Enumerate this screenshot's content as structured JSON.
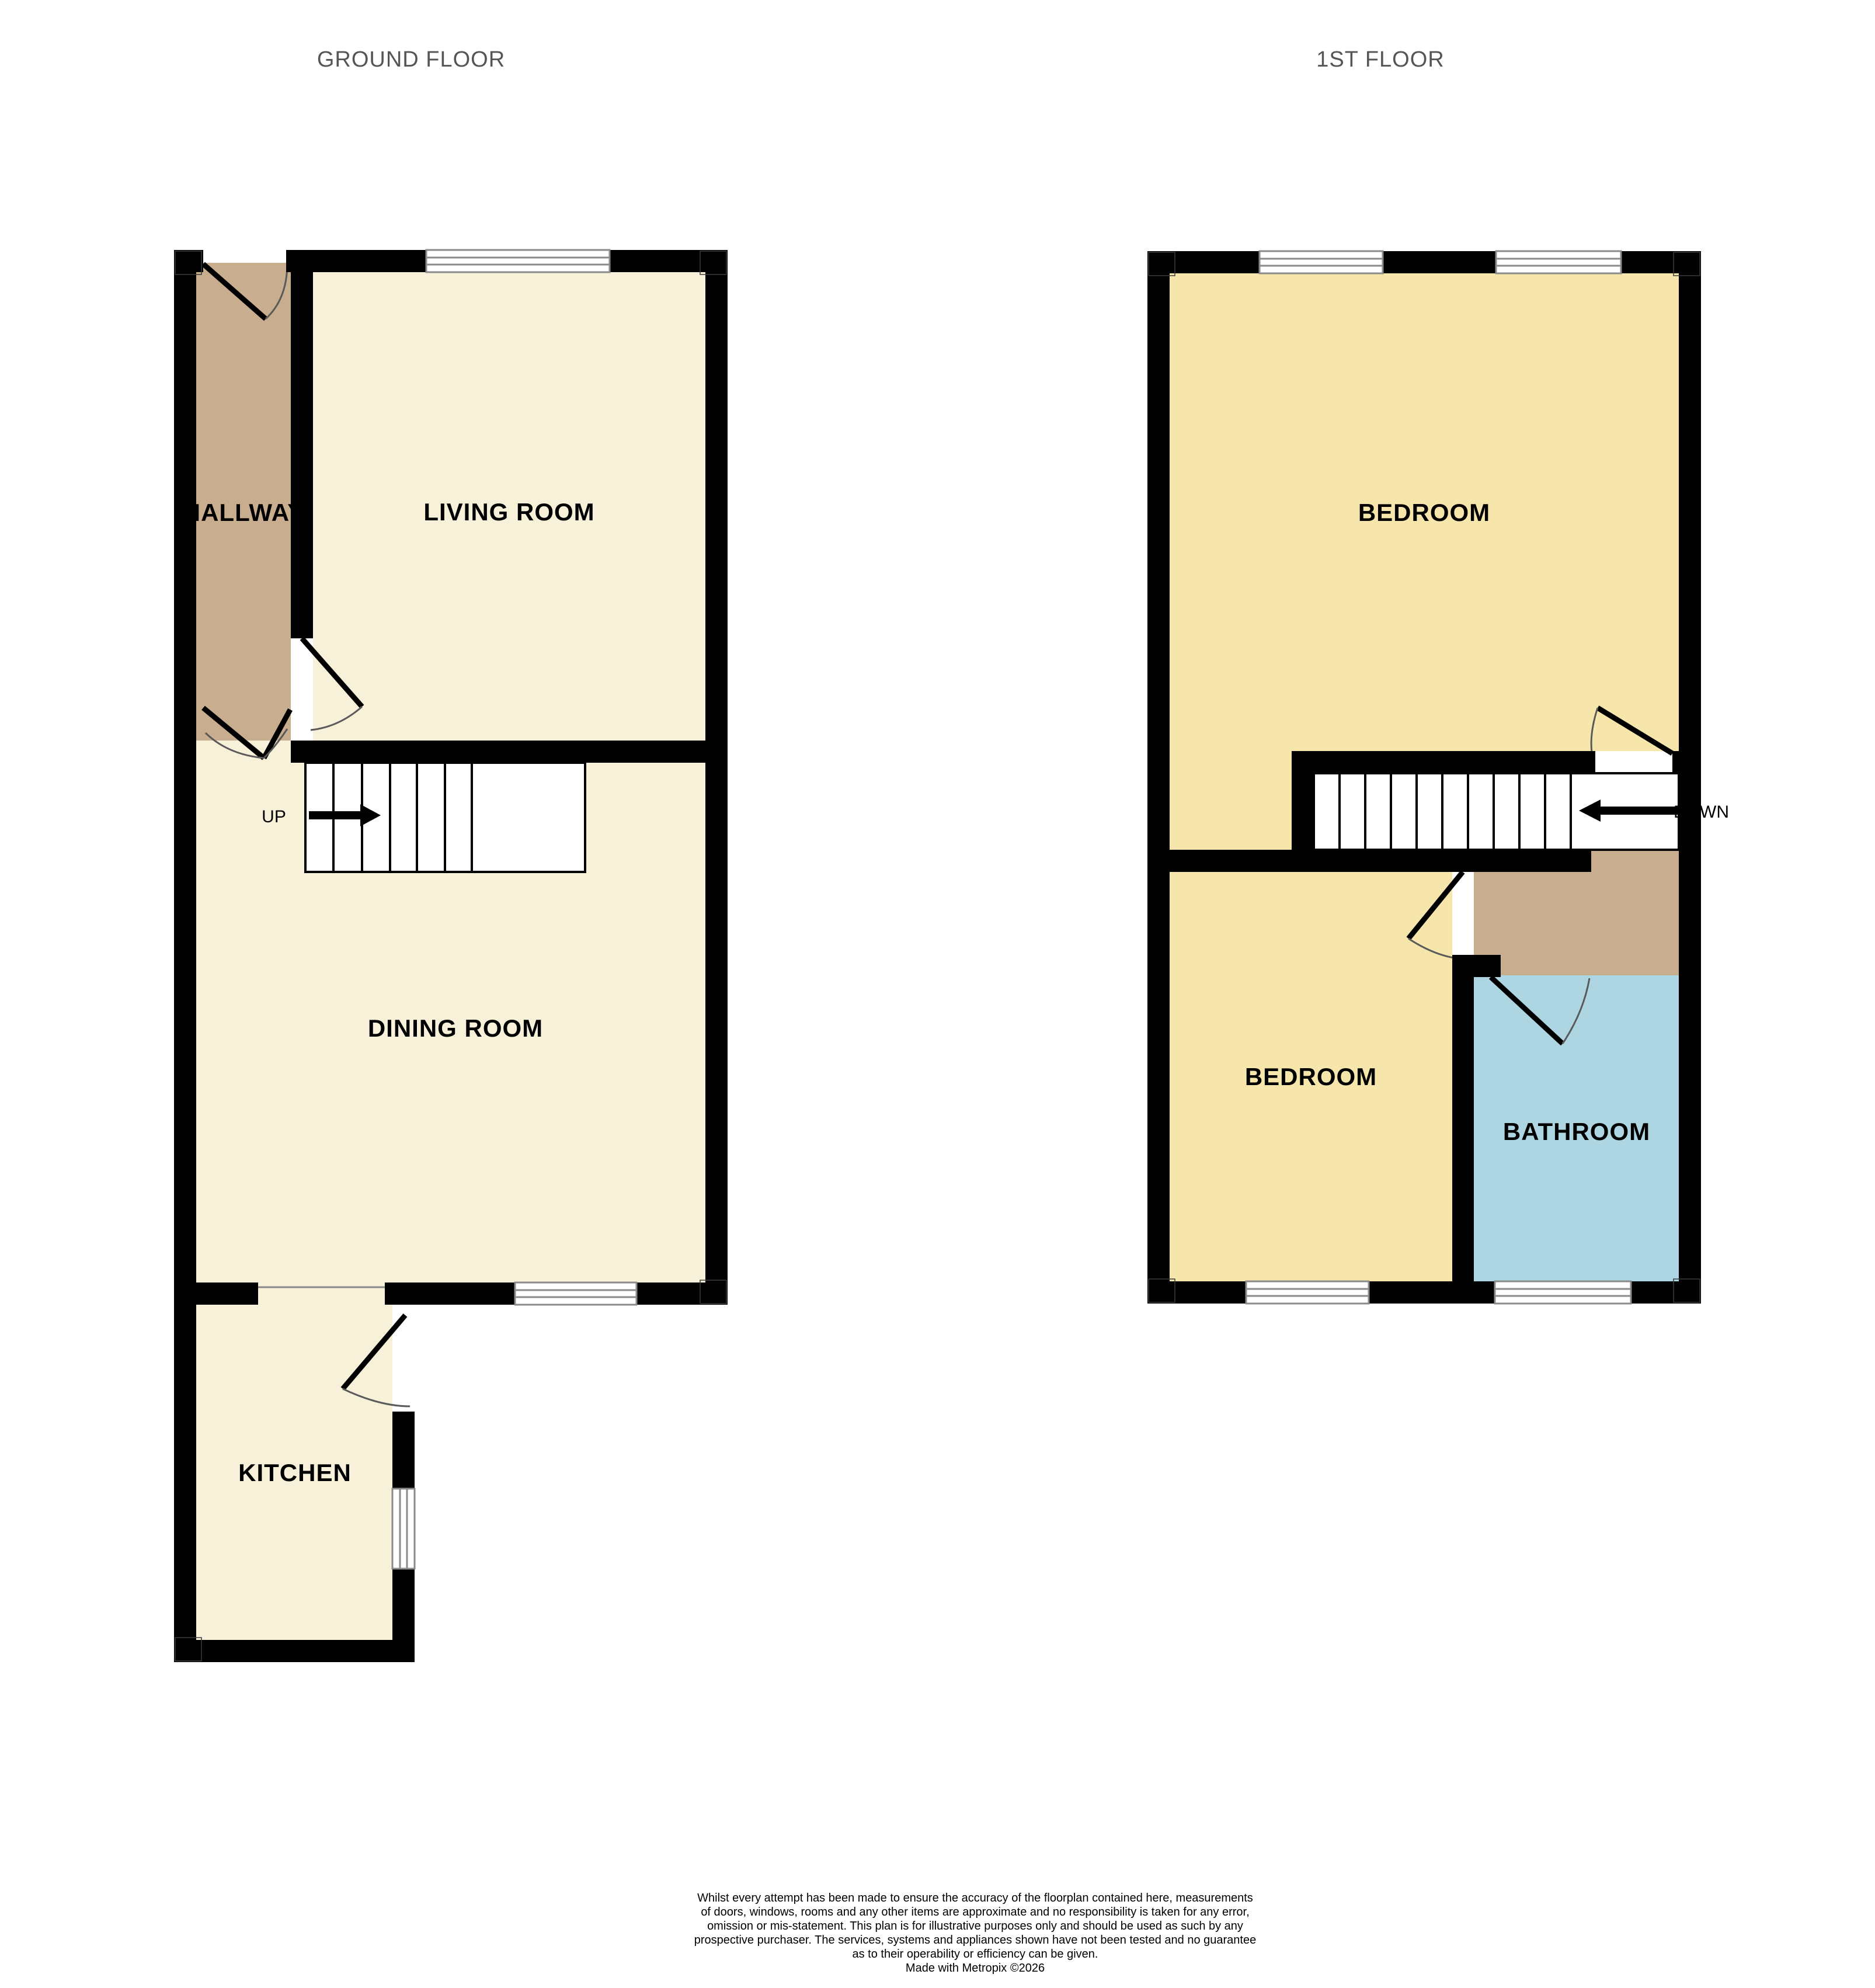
{
  "ground_floor": {
    "label": "GROUND FLOOR",
    "hallway": "HALLWAY",
    "living_room": "LIVING ROOM",
    "dining_room": "DINING ROOM",
    "kitchen": "KITCHEN",
    "stair_direction": "UP"
  },
  "first_floor": {
    "label": "1ST FLOOR",
    "bedroom1": "BEDROOM",
    "bedroom2": "BEDROOM",
    "bathroom": "BATHROOM",
    "stair_direction": "DOWN"
  },
  "colors": {
    "wall": "#000000",
    "room_cream": "#F7F1DA",
    "hallway_tan": "#C8AE8E",
    "landing_tan": "#C8AE8E",
    "bedroom_yellow": "#F7E6AC",
    "bathroom_blue": "#AED6E2",
    "window_line": "#8A8A8A",
    "door_arc": "#5A5A5A",
    "floor_label_text": "#555555"
  },
  "disclaimer": {
    "lines": [
      "Whilst every attempt has been made to ensure the accuracy of the floorplan contained here, measurements",
      "of doors, windows, rooms and any other items are approximate and no responsibility is taken for any error,",
      "omission or mis-statement. This plan is for illustrative purposes only and should be used as such by any",
      "prospective purchaser. The services, systems and appliances shown have not been tested and no guarantee",
      "as to their operability or efficiency can be given.",
      "Made with Metropix ©2026"
    ]
  }
}
